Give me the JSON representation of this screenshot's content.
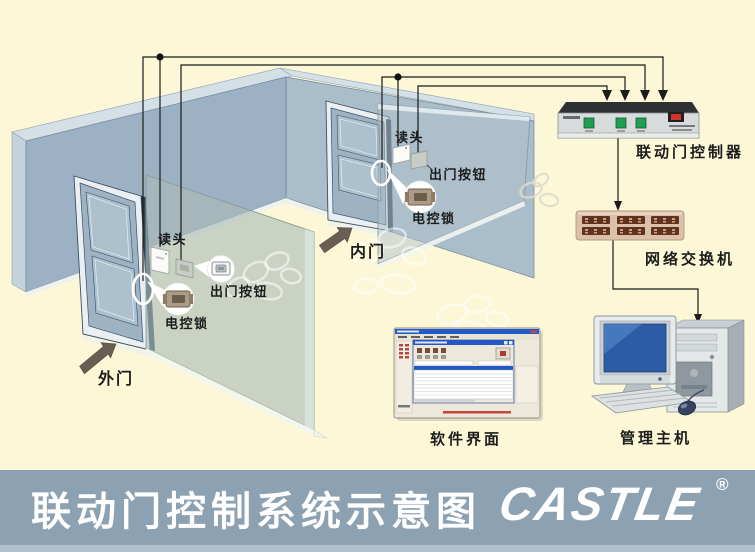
{
  "page": {
    "background": "#FBF7D7"
  },
  "diagram": {
    "doors": {
      "outer": "外门",
      "inner": "内门"
    },
    "outer_devices": {
      "reader": "读头",
      "exit_button": "出门按钮",
      "lock": "电控锁"
    },
    "inner_devices": {
      "reader": "读头",
      "exit_button": "出门按钮",
      "lock": "电控锁"
    },
    "equipment": {
      "controller": "联动门控制器",
      "switch": "网络交换机",
      "software": "软件界面",
      "host": "管理主机"
    }
  },
  "footer": {
    "title": "联动门控制系统示意图",
    "brand": "CASTLE",
    "registered": "®"
  },
  "colors": {
    "background": "#FBF7D7",
    "footer_bar": "#8CA1B1",
    "footer_strip": "#B2C0CB",
    "wall_left": "#9CB1C3",
    "wall_right": "#A9BDCB",
    "door_slab": "#9DB3C4",
    "partition": "#ABBAB5",
    "wire": "#1B1B1B",
    "arrow": "#6A5E53",
    "controller_top": "#2E3134",
    "controller_face": "#D7DBDB",
    "controller_button": "#1E9E55",
    "controller_led": "#D3342A",
    "switch_body": "#DCC0A9",
    "switch_port": "#5D3322",
    "monitor_screen": "#2B5CA5",
    "window_title_blue": "#2457C6",
    "lock_body": "#AC9B85"
  },
  "icons": {
    "flow_arrowhead": "down-arrowhead-icon",
    "junction": "wire-junction-dot"
  }
}
